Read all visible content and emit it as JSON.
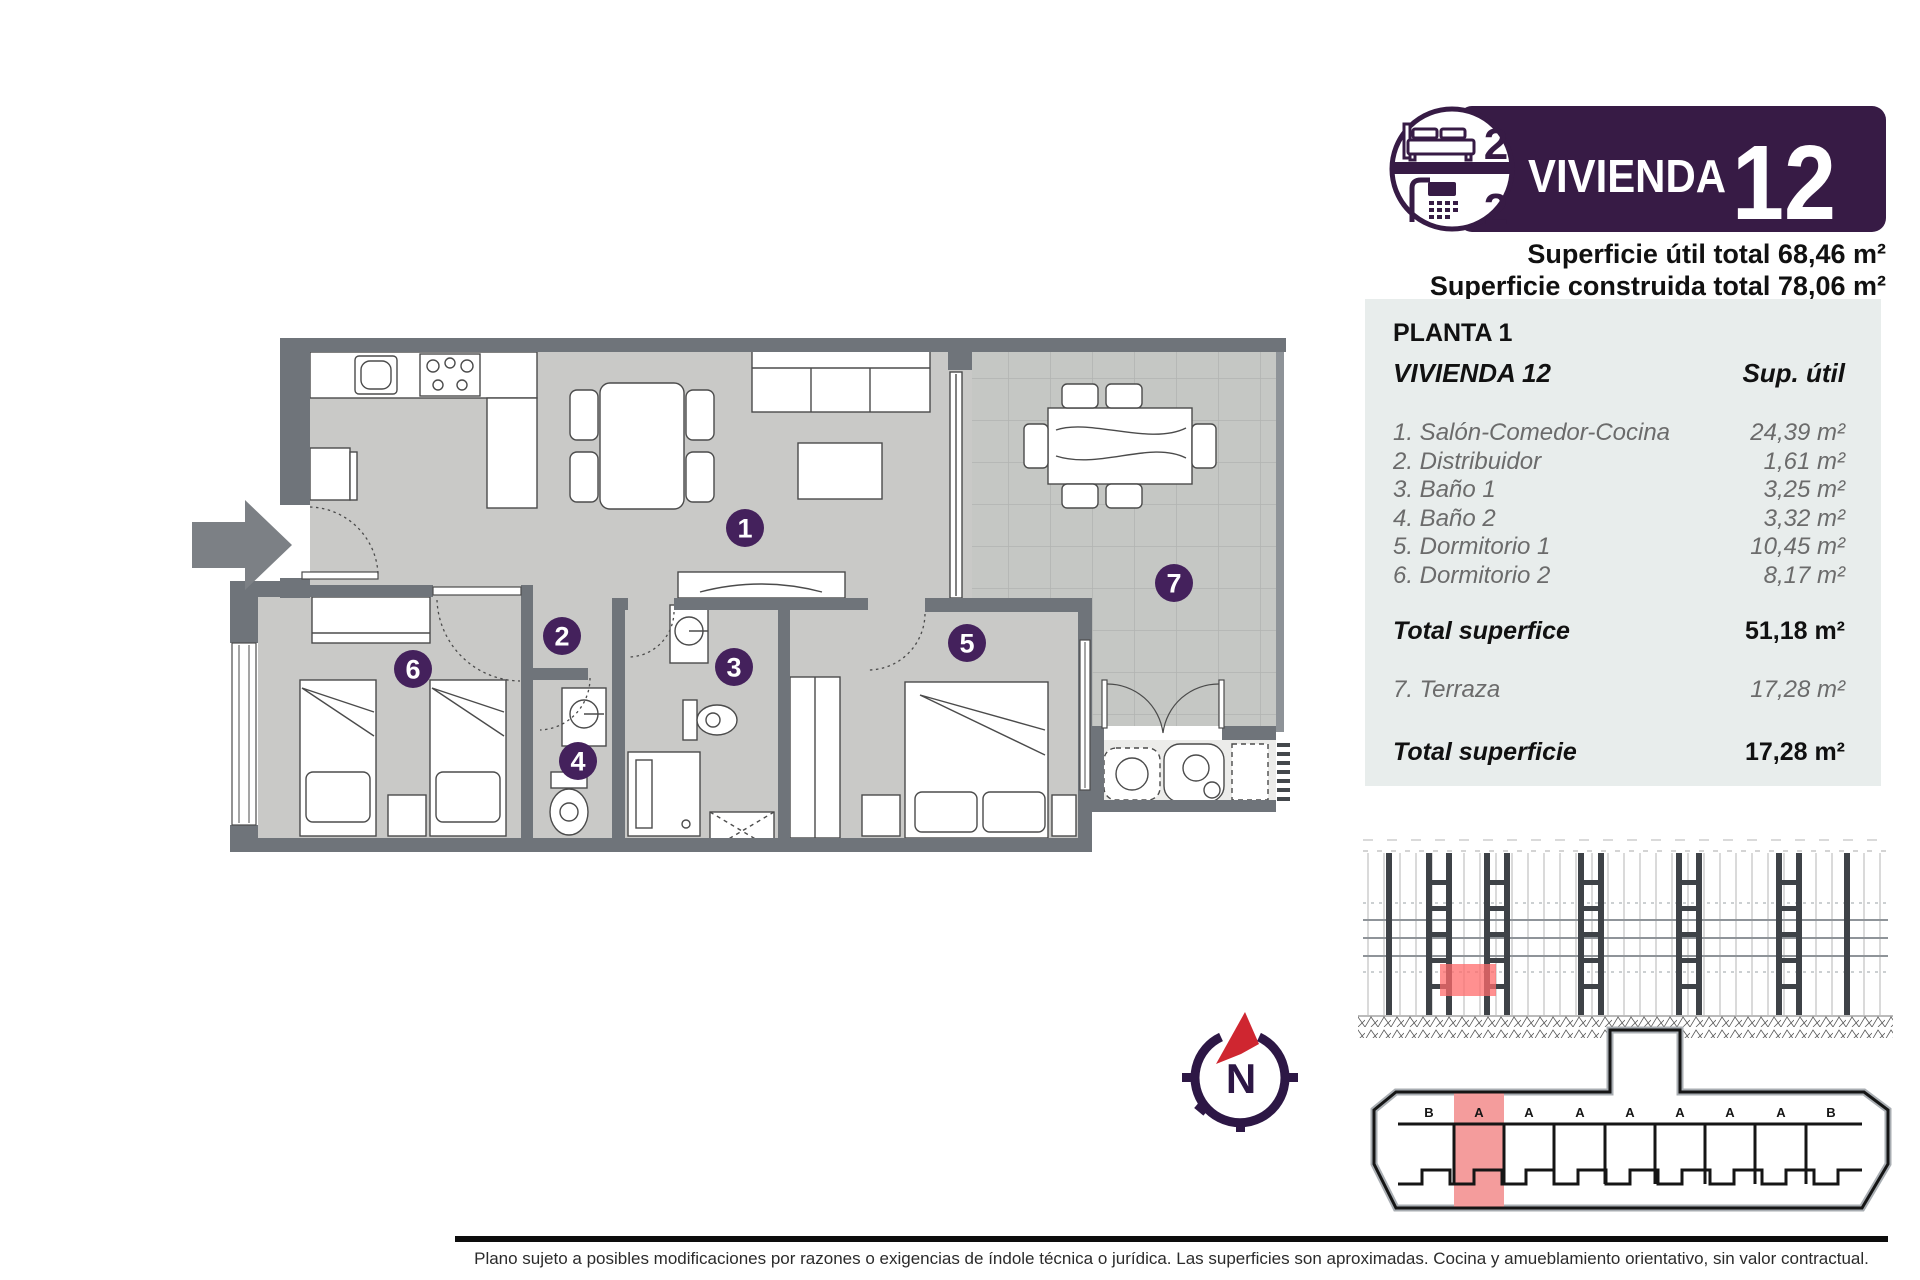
{
  "header": {
    "badge": {
      "bedrooms": "2",
      "bathrooms": "2"
    },
    "title": "VIVIENDA",
    "number": "12",
    "superficie_util": "Superficie útil total 68,46 m²",
    "superficie_construida": "Superficie construida total 78,06 m²"
  },
  "table": {
    "floor": "PLANTA 1",
    "unit": "VIVIENDA 12",
    "col_header": "Sup. útil",
    "rows": [
      {
        "label": "1. Salón-Comedor-Cocina",
        "value": "24,39 m²"
      },
      {
        "label": "2. Distribuidor",
        "value": "1,61 m²"
      },
      {
        "label": "3. Baño 1",
        "value": "3,25 m²"
      },
      {
        "label": "4. Baño 2",
        "value": "3,32 m²"
      },
      {
        "label": "5. Dormitorio 1",
        "value": "10,45 m²"
      },
      {
        "label": "6. Dormitorio 2",
        "value": "8,17 m²"
      }
    ],
    "total_interior": {
      "label": "Total superfice",
      "value": "51,18 m²"
    },
    "terraza": {
      "label": "7. Terraza",
      "value": "17,28 m²"
    },
    "total_terraza": {
      "label": "Total superficie",
      "value": "17,28 m²"
    }
  },
  "plan": {
    "room_numbers": [
      "1",
      "2",
      "3",
      "4",
      "5",
      "6",
      "7"
    ]
  },
  "compass": {
    "label": "N"
  },
  "site": {
    "letters": [
      "B",
      "A",
      "A",
      "A",
      "A",
      "A",
      "A",
      "A",
      "B"
    ]
  },
  "footer": {
    "disclaimer": "Plano sujeto a posibles modificaciones por razones o exigencias de índole técnica o jurídica. Las superficies son aproximadas. Cocina y amueblamiento orientativo, sin valor contractual."
  },
  "colors": {
    "accent_purple": "#371b45",
    "badge_purple": "#44215c",
    "compass_red": "#cf2630",
    "highlight_red": "#f49c9c",
    "wall_gray": "#6f747a",
    "floor_gray": "#c9c9c7",
    "panel_bg": "#e8edec"
  }
}
